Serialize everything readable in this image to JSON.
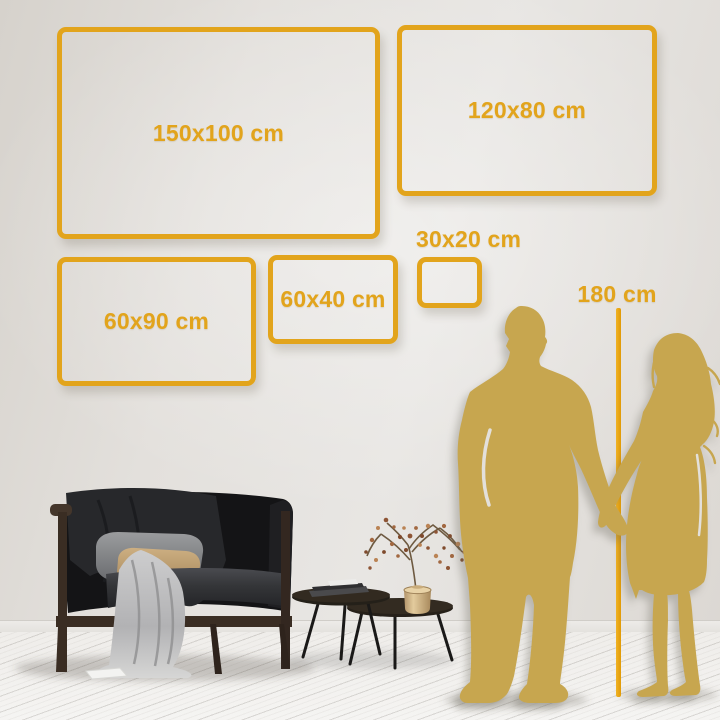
{
  "sizes": {
    "frames": [
      {
        "id": "150x100",
        "label": "150x100 cm"
      },
      {
        "id": "120x80",
        "label": "120x80 cm"
      },
      {
        "id": "60x90",
        "label": "60x90 cm"
      },
      {
        "id": "60x40",
        "label": "60x40 cm"
      },
      {
        "id": "30x20",
        "label": "30x20 cm"
      }
    ],
    "height_reference": {
      "label": "180 cm"
    }
  },
  "colors": {
    "frame_gold": "#E2A41C",
    "label_gold": "#E2A41C",
    "silhouette_gold": "#C7A64F",
    "ruler_gold": "#E8A30B",
    "wall": "#E3E0DC",
    "floor": "#F3F2F0"
  }
}
